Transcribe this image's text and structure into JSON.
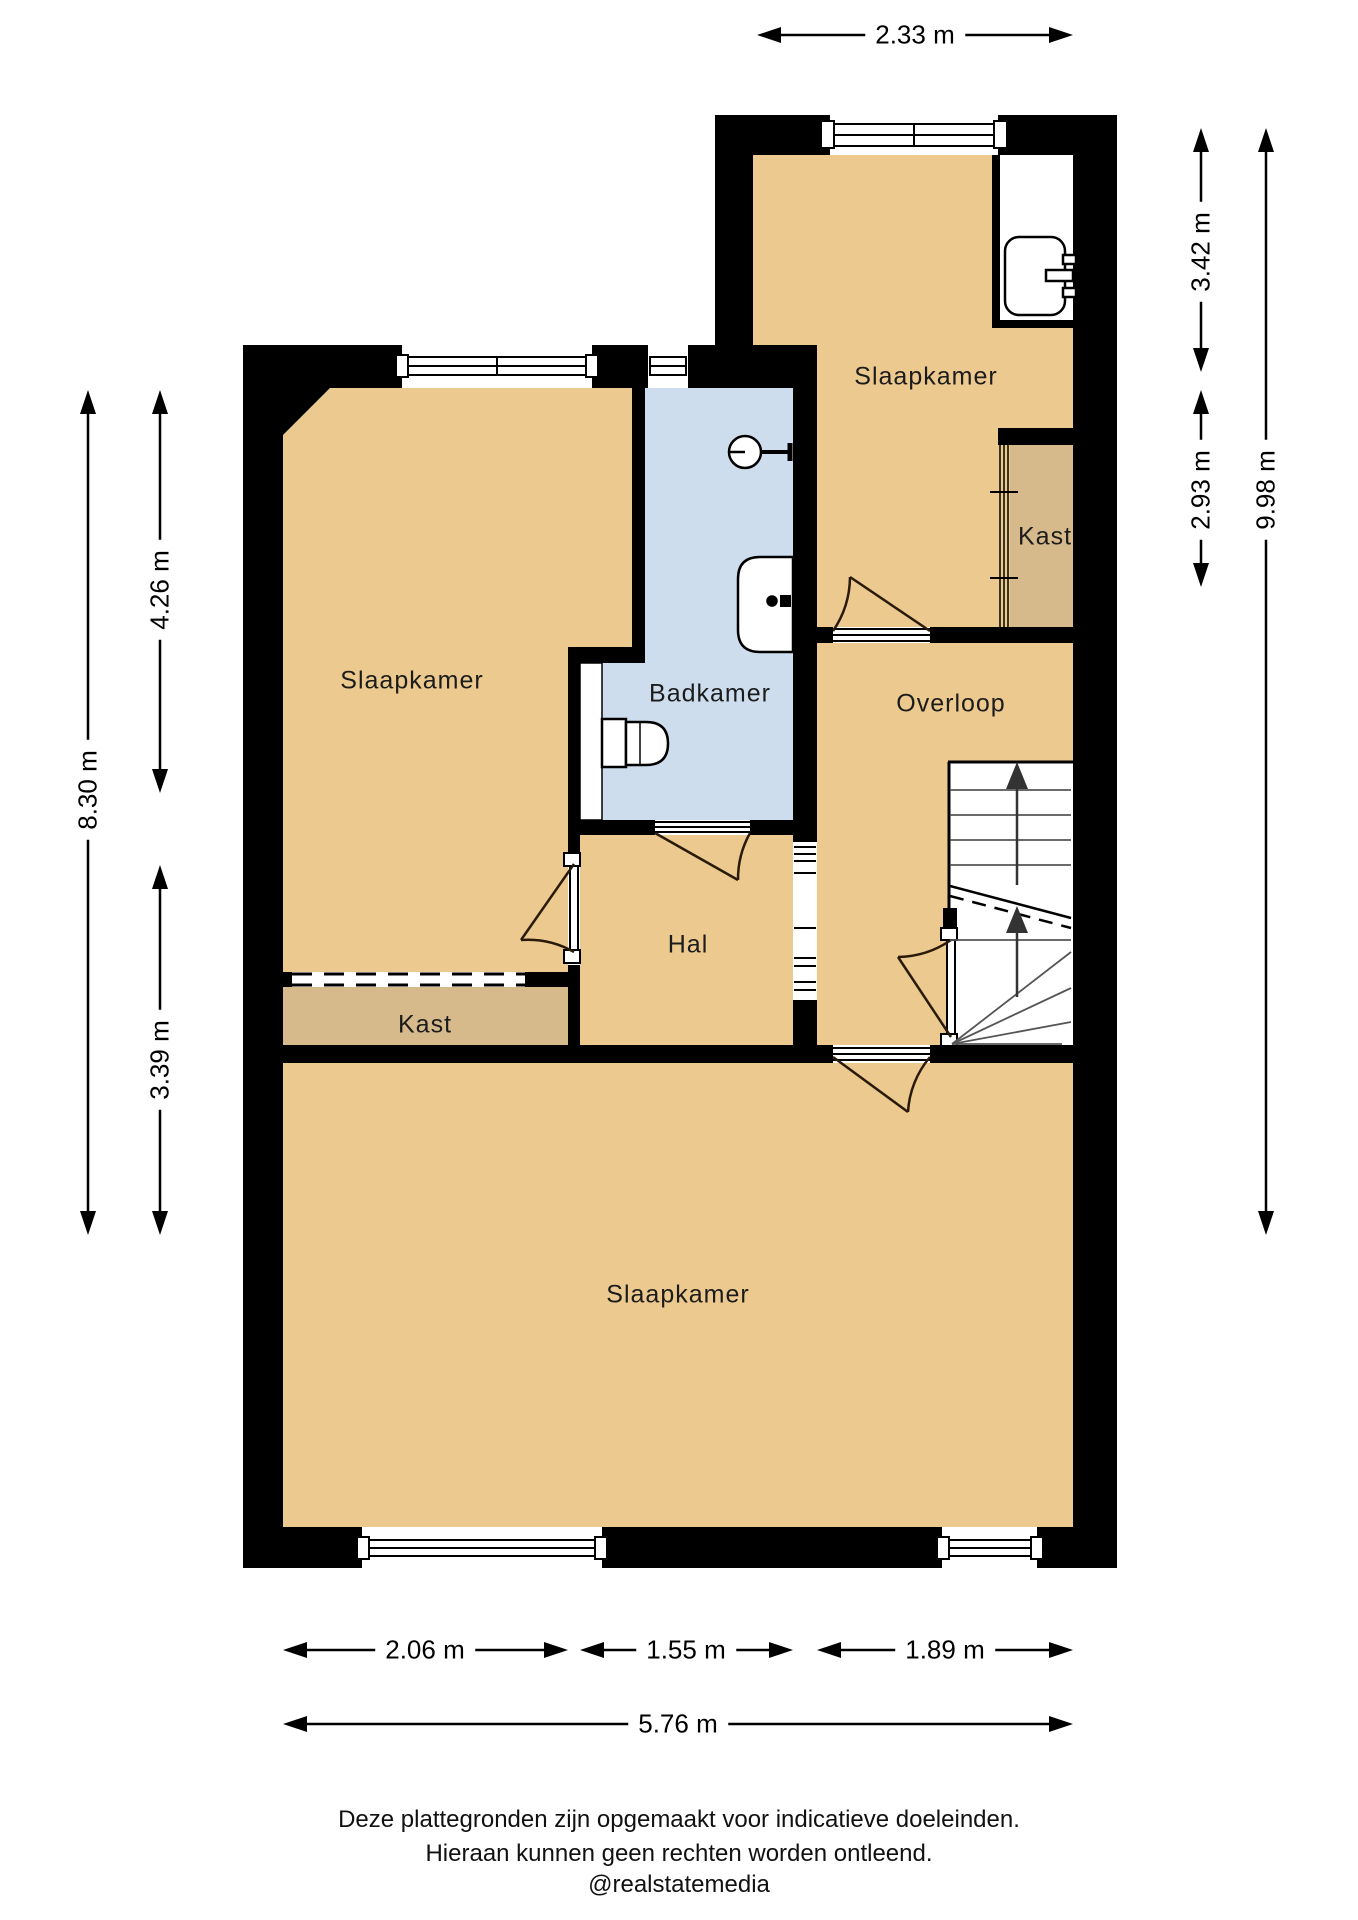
{
  "rooms": {
    "slaapkamer_top": "Slaapkamer",
    "kast_right": "Kast",
    "slaapkamer_left": "Slaapkamer",
    "badkamer": "Badkamer",
    "overloop": "Overloop",
    "hal": "Hal",
    "kast_left": "Kast",
    "slaapkamer_bottom": "Slaapkamer"
  },
  "dimensions": {
    "top_width": "2.33 m",
    "right_top": "3.42 m",
    "right_middle": "2.93 m",
    "right_total": "9.98 m",
    "left_top": "4.26 m",
    "left_bottom": "3.39 m",
    "left_total": "8.30 m",
    "bottom_left": "2.06 m",
    "bottom_middle": "1.55 m",
    "bottom_right": "1.89 m",
    "bottom_total": "5.76 m"
  },
  "footer": {
    "line1": "Deze plattegronden zijn opgemaakt voor indicatieve doeleinden.",
    "line2": "Hieraan kunnen geen rechten worden ontleend.",
    "line3": "@realstatemedia"
  },
  "icons": {
    "shower": "shower-head-icon",
    "bath_sink": "washbasin-icon",
    "bedroom_sink": "washbasin-icon",
    "toilet": "toilet-icon",
    "stairs": "staircase-symbol"
  },
  "colors": {
    "room": "#ecc98e",
    "closet": "#d6ba8b",
    "bathroom": "#cedded",
    "wall": "#000000"
  }
}
